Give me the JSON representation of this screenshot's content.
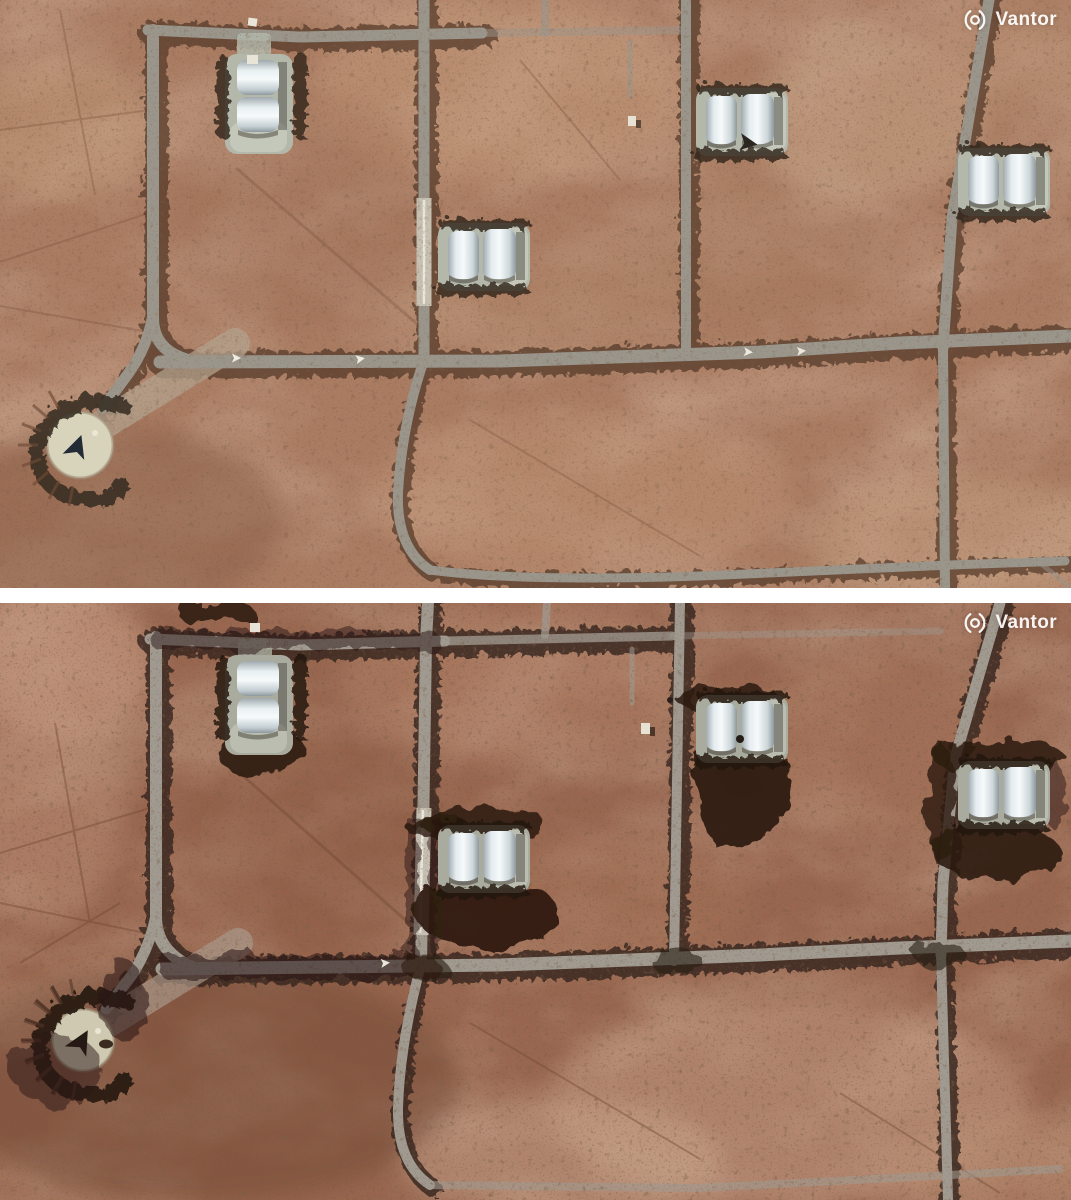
{
  "window": {
    "width_px": 1071,
    "height_px": 1200,
    "divider_color": "#ffffff"
  },
  "watermark": {
    "brand": "Vantor",
    "icon": "vantor-aperture-logo",
    "text_color": "#ffffff"
  },
  "panels": [
    {
      "id": "top",
      "name": "satellite-image-top",
      "watermark_brand": "Vantor",
      "scene": "desert airbase with hardened aircraft shelters, road grid and alert pad",
      "palette": {
        "terrain_base": "#aa7c62",
        "terrain_light_patch": "#c69c7c",
        "road": "#9b968c",
        "road_vegetation": "#4f3627",
        "shelter_roof": "#f6fafb",
        "apron": "#b3b8ab",
        "berm": "#32281c",
        "alert_pad": "#d8d3bb"
      },
      "features": [
        "shelter-pair-northwest",
        "shelter-pair-center",
        "shelter-pair-northeast",
        "shelter-pair-east",
        "road-grid",
        "alert-pad-with-aircraft",
        "parked-aircraft-on-road",
        "desert-scrub"
      ]
    },
    {
      "id": "bottom",
      "name": "satellite-image-bottom",
      "watermark_brand": "Vantor",
      "scene": "same airbase with scorched ground around the shelters",
      "palette": {
        "terrain_base": "#996750",
        "terrain_light_patch": "#cda289",
        "road": "#a09a90",
        "road_vegetation": "#33221a",
        "shelter_roof": "#eef3f4",
        "apron": "#a8ab9d",
        "berm": "#221710",
        "burn_scar": "#2a1a11",
        "alert_pad": "#cfc9b1"
      },
      "features": [
        "shelter-pair-northwest",
        "shelter-pair-center",
        "shelter-pair-northeast",
        "shelter-pair-east",
        "road-grid",
        "alert-pad-with-aircraft",
        "burn-scars-around-shelters",
        "desert-scrub"
      ]
    }
  ]
}
